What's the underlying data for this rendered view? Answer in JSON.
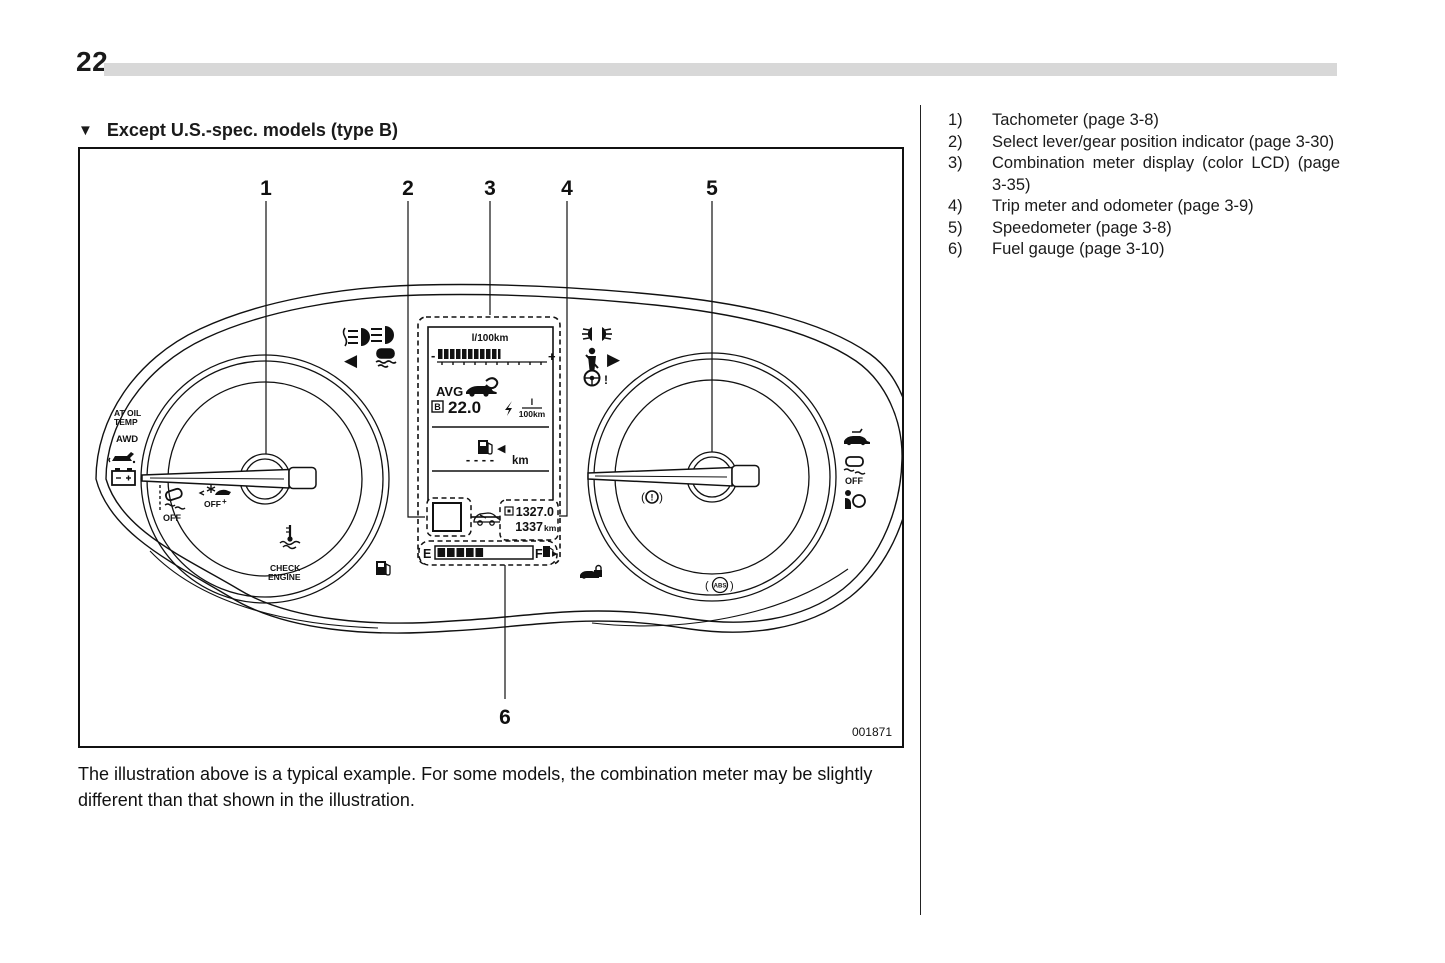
{
  "page": {
    "number": "22",
    "heading_marker": "▼",
    "heading": "Except U.S.-spec. models (type B)",
    "figure_code": "001871",
    "caption": "The illustration above is a typical example. For some models, the combination meter may be slightly different than that shown in the illustration."
  },
  "legend": {
    "items": [
      {
        "num": "1)",
        "text": "Tachometer (page 3-8)"
      },
      {
        "num": "2)",
        "text": "Select lever/gear position indicator (page 3-30)"
      },
      {
        "num": "3)",
        "text": "Combination meter display (color LCD) (page 3-35)"
      },
      {
        "num": "4)",
        "text": "Trip meter and odometer (page 3-9)"
      },
      {
        "num": "5)",
        "text": "Speedometer (page 3-8)"
      },
      {
        "num": "6)",
        "text": "Fuel gauge (page 3-10)"
      }
    ]
  },
  "callouts": {
    "c1": "1",
    "c2": "2",
    "c3": "3",
    "c4": "4",
    "c5": "5",
    "c6": "6"
  },
  "lcd": {
    "consumption_unit": "l/100km",
    "minus": "-",
    "plus": "+",
    "avg_label": "AVG",
    "avg_mode": "B",
    "avg_value": "22.0",
    "avg_unit_top": "l",
    "avg_unit_bottom": "100km",
    "range_dashes": "- - - -",
    "range_unit": "km",
    "trip_value": "1327.0",
    "odo_value": "1337",
    "odo_unit": "km",
    "fuel_empty": "E",
    "fuel_full": "F",
    "fuel_arrow": "▶"
  },
  "telltales": {
    "at_oil_line1": "AT OIL",
    "at_oil_line2": "TEMP",
    "awd": "AWD",
    "vdc_off": "OFF",
    "star_off": "OFF",
    "star_plus": "+",
    "check_line1": "CHECK",
    "check_line2": "ENGINE",
    "paren_open": "(",
    "paren_close": ")",
    "brake_mark": "!",
    "abs": "ABS",
    "vdc_off_right": "OFF",
    "turn_left": "◀",
    "turn_right": "▶",
    "steering_mark": "!"
  },
  "colors": {
    "ink": "#1a1a1a",
    "rule_gray": "#d8d8d8"
  }
}
